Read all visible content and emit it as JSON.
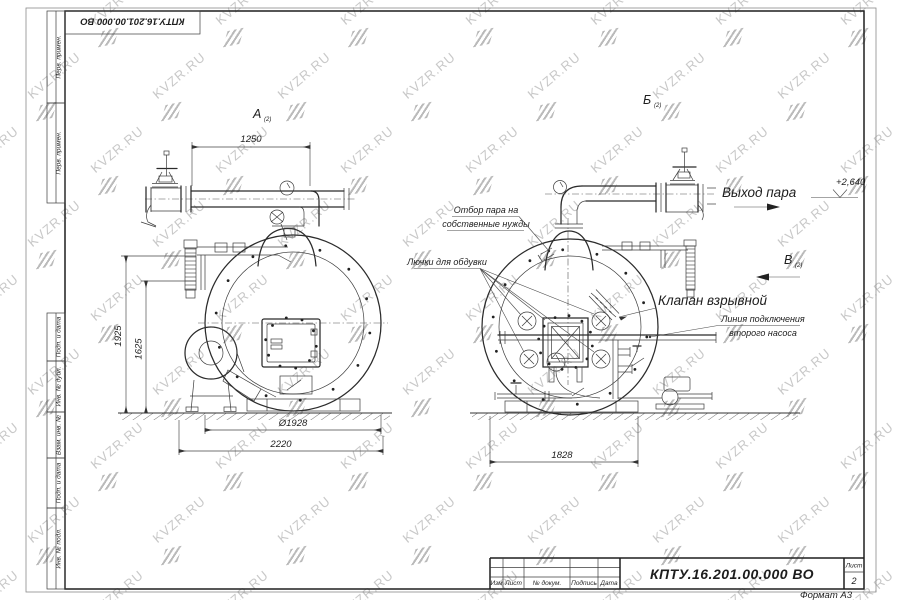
{
  "watermark": {
    "text": "KVZR.RU"
  },
  "frame": {
    "stamp_top": "КПТУ.16.201.00.000  ВО",
    "left_strip_top": [
      "Перв. примен.",
      "Перв. примен."
    ],
    "left_strip_bottom": [
      "Подп. и дата",
      "Инв. № дубл.",
      "Взам. инв. №",
      "Подп. и дата",
      "Инв. № подл."
    ],
    "title_block": {
      "columns": [
        "Изм",
        "Лист",
        "№ докум.",
        "Подпись",
        "Дата"
      ],
      "doc_number": "КПТУ.16.201.00.000  ВО",
      "sheet_label": "Лист",
      "sheet_number": "2",
      "format_label": "Формат А3"
    }
  },
  "views": {
    "left": {
      "label": "А",
      "label_sub": "(2)",
      "dims": {
        "top": "1250",
        "height1": "1925",
        "height2": "1625",
        "diameter": "Ø1928",
        "width": "2220"
      }
    },
    "right": {
      "label": "Б",
      "label_sub": "(2)",
      "view_c": "В",
      "view_c_sub": "(2)",
      "dims": {
        "width": "1828"
      },
      "annotations": {
        "steam_out": "Выход пара",
        "level": "+2,640",
        "steam_tap_1": "Отбор пара на",
        "steam_tap_2": "собственные нужды",
        "hatches": "Лючки для обдувки",
        "valve": "Клапан взрывной",
        "pump_line_1": "Линия подключения",
        "pump_line_2": "второго насоса"
      }
    }
  }
}
